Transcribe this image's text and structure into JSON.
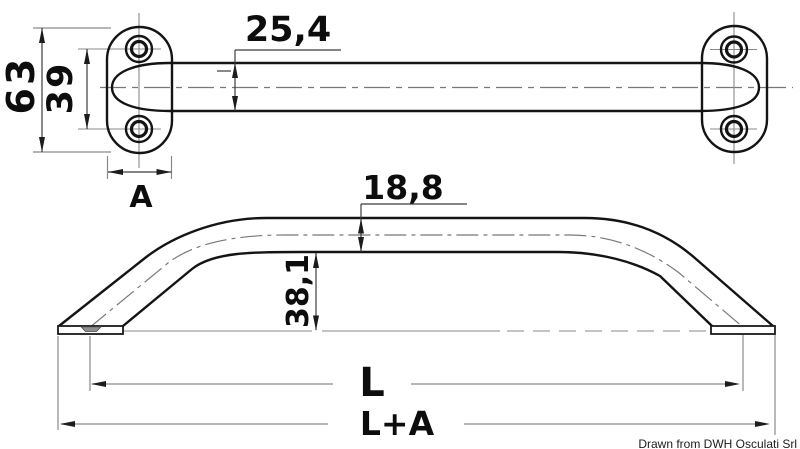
{
  "drawing": {
    "type": "technical-dimension-drawing",
    "subject": "oval-base handrail, top view and side view",
    "credit": "Drawn from DWH Osculati Srl"
  },
  "colors": {
    "background": "#ffffff",
    "outline": "#141414",
    "thin_line": "#8a8a8a",
    "centerline": "#777777",
    "dimension_line": "#3c3c3c",
    "text": "#0d0d0d",
    "foot_section_fill": "#8f8f8f"
  },
  "labels": {
    "flange_height": "63",
    "hole_spacing": "39",
    "tube_diameter": "25,4",
    "flange_width_letter": "A",
    "tube_od_side": "18,8",
    "rail_rise": "38,1",
    "length_letter": "L",
    "overall_length_letter": "L+A",
    "credit": "Drawn from DWH Osculati Srl"
  }
}
